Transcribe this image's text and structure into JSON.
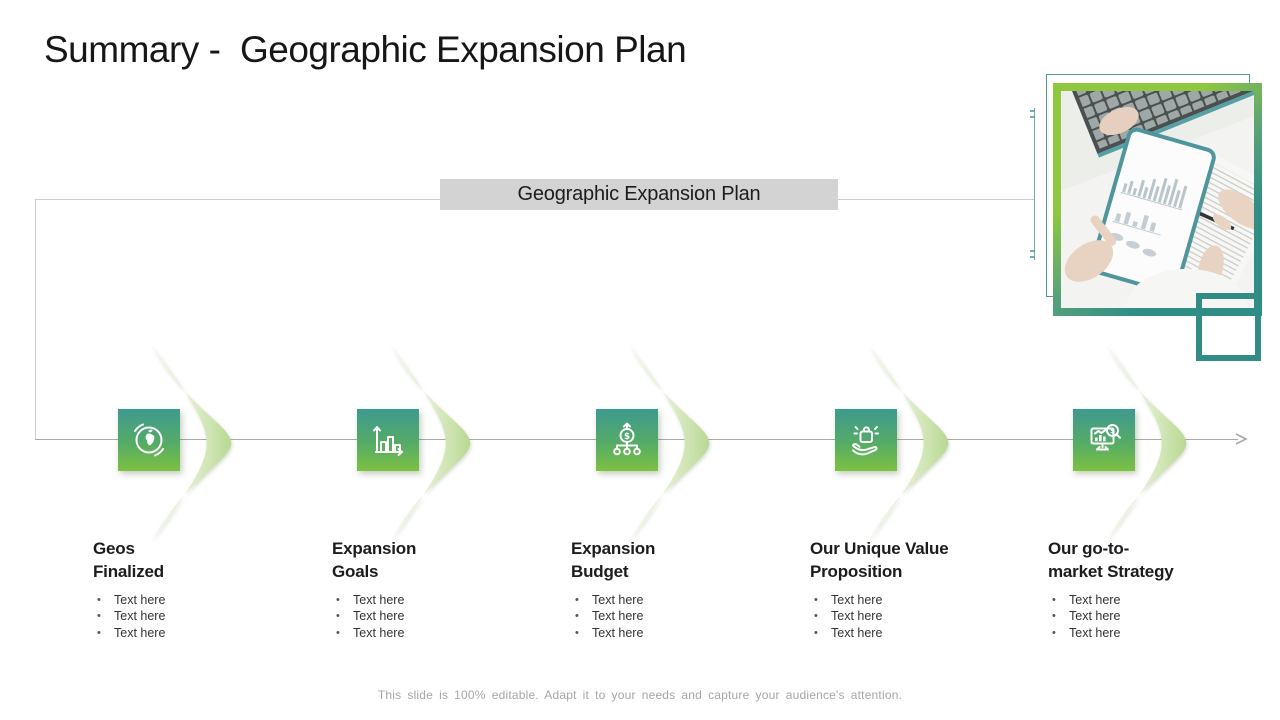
{
  "slide": {
    "title": "Summary -  Geographic Expansion Plan",
    "banner_label": "Geographic Expansion Plan",
    "footer_note": "This slide is 100% editable. Adapt it to your needs and capture your audience's attention."
  },
  "colors": {
    "accent_teal": "#3d9a8f",
    "accent_green": "#7cc142",
    "frame_green": "#8fc73e",
    "frame_teal": "#2f8d85",
    "banner_bg": "#d3d3d3",
    "chevron_green": "#b9d893",
    "line_gray": "#cccccc",
    "timeline_gray": "#ababab"
  },
  "steps": [
    {
      "icon": "globe-icon",
      "title_line1": "Geos",
      "title_line2": "Finalized",
      "bullets": [
        "Text here",
        "Text here",
        "Text here"
      ]
    },
    {
      "icon": "bar-chart-icon",
      "title_line1": "Expansion",
      "title_line2": "Goals",
      "bullets": [
        "Text here",
        "Text here",
        "Text here"
      ]
    },
    {
      "icon": "budget-allocation-icon",
      "title_line1": "Expansion",
      "title_line2": "Budget",
      "bullets": [
        "Text here",
        "Text here",
        "Text here"
      ]
    },
    {
      "icon": "hand-gift-icon",
      "title_line1": "Our Unique Value",
      "title_line2": "Proposition",
      "bullets": [
        "Text here",
        "Text here",
        "Text here"
      ]
    },
    {
      "icon": "market-analytics-icon",
      "title_line1": "Our go-to-",
      "title_line2": "market Strategy",
      "bullets": [
        "Text here",
        "Text here",
        "Text here"
      ]
    }
  ]
}
